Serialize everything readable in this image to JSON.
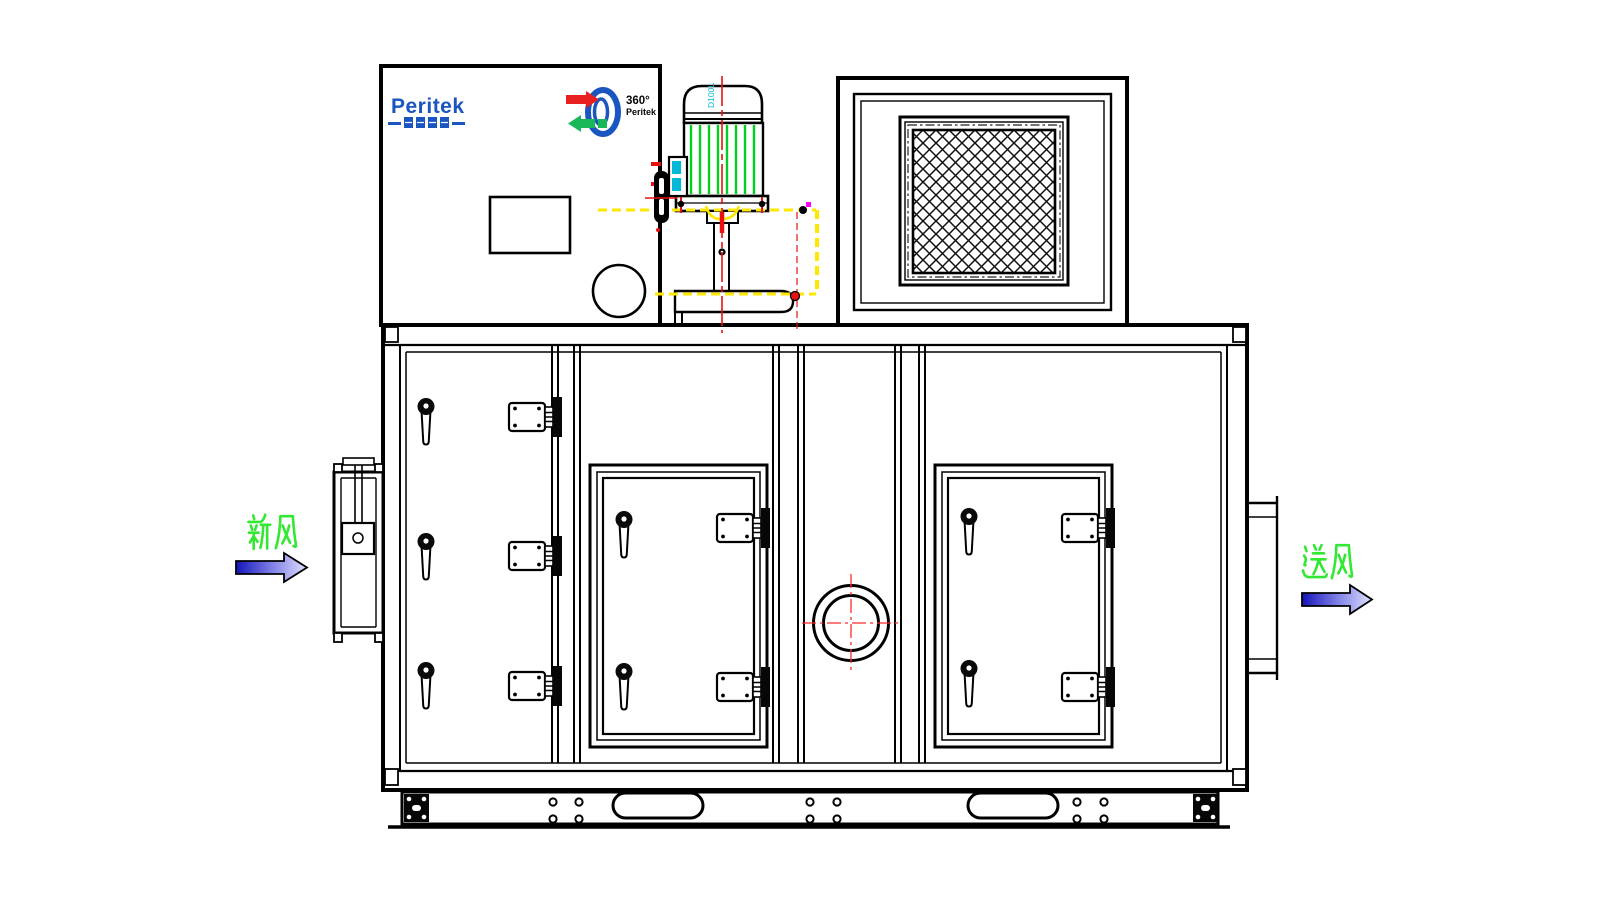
{
  "meta": {
    "drawing_type": "dehumidifier-unit-front-view-cad",
    "background_color": "#ffffff",
    "line_color": "#000000"
  },
  "brand": {
    "name": "Peritek",
    "name_cn": "普瑞泰克",
    "rotor_degree": "360°",
    "rotor_sub": "Peritek",
    "logo_color": "#1a55c0",
    "rotor_arrow_in_color": "#e82020",
    "rotor_arrow_out_color": "#18b858"
  },
  "motor": {
    "label": "D100L",
    "label_color": "#00b8d8",
    "fin_color": "#00d020",
    "centerline_color": "#e81010"
  },
  "airflow": {
    "inlet_label": "新风",
    "outlet_label": "送风",
    "label_color": "#33e833",
    "arrow_gradient_start": "#1414bb",
    "arrow_gradient_end": "#e0e0ff"
  },
  "annotations": {
    "hidden_line_color": "#ffe800",
    "crosshair_color": "#ff2a2a",
    "marker_magenta": "#ff00ff"
  }
}
